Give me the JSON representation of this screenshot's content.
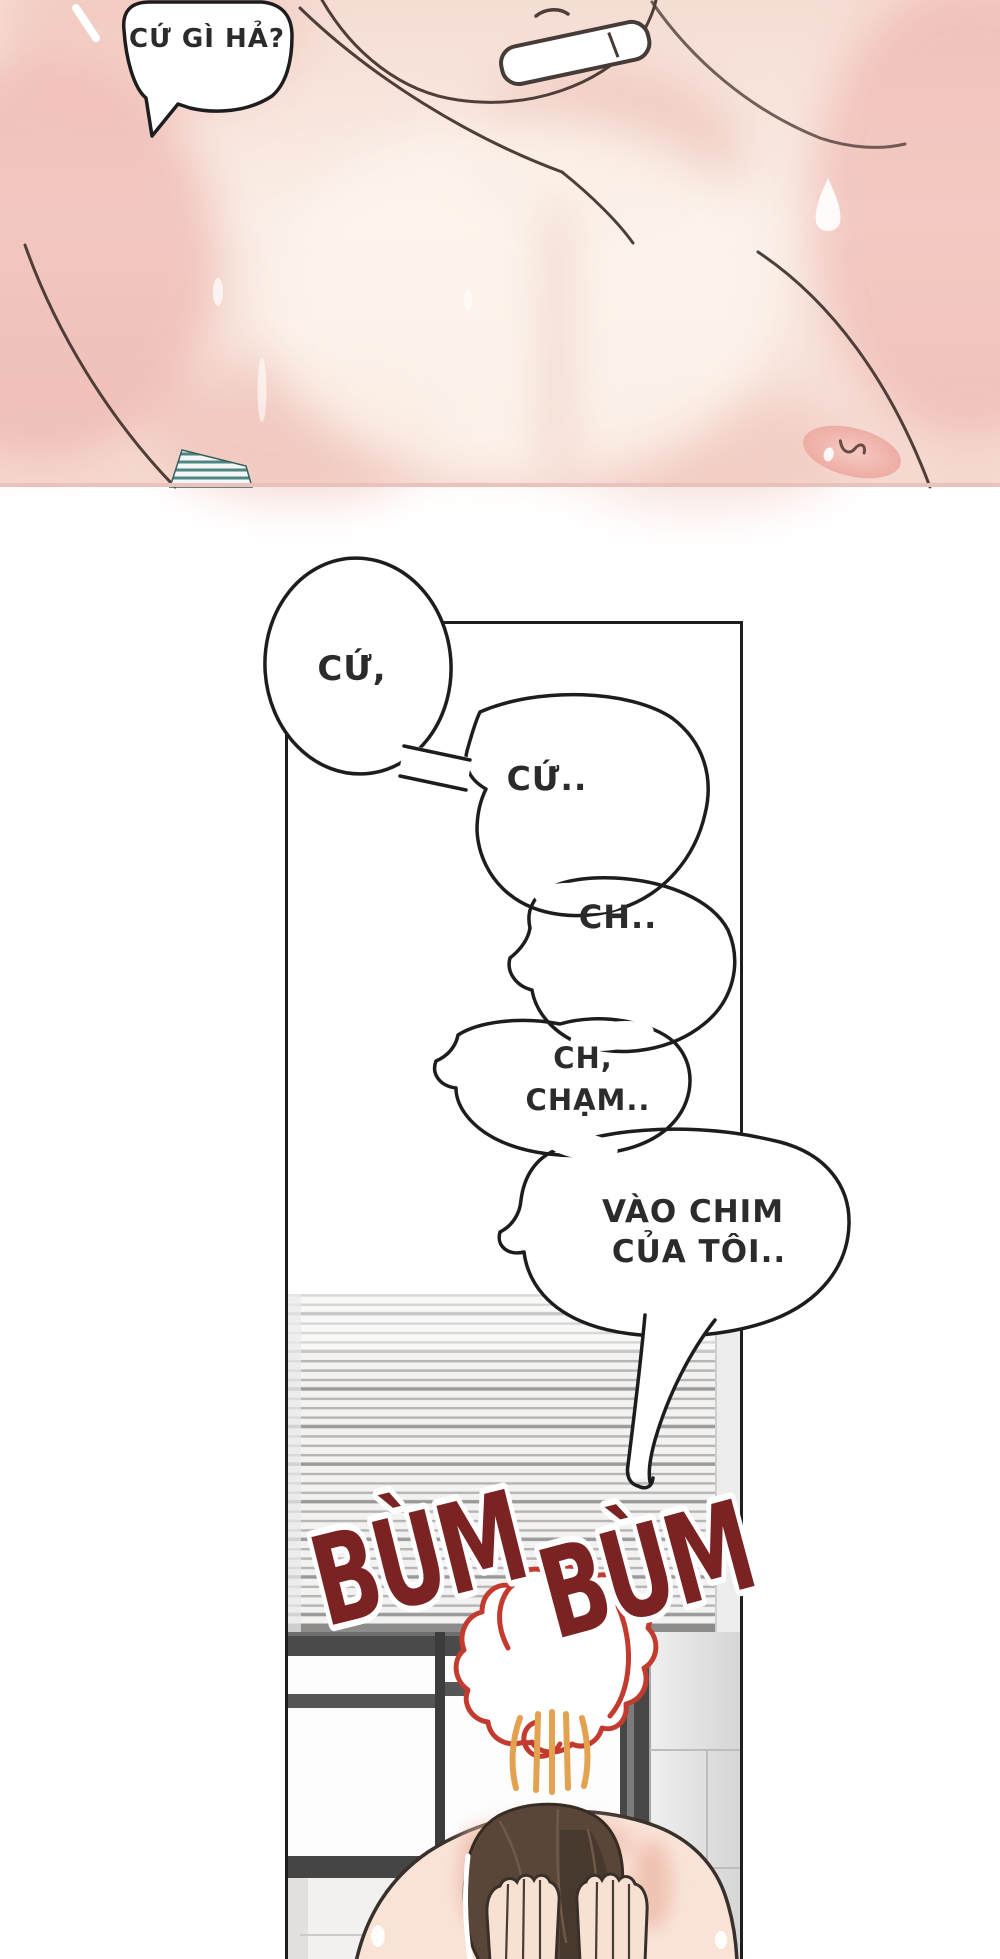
{
  "bubbles": {
    "top": {
      "text": "CỨ GÌ HẢ?"
    },
    "chain": [
      {
        "text": "CỨ,"
      },
      {
        "text": "CỨ.."
      },
      {
        "text": "CH.."
      },
      {
        "lines": [
          "CH,",
          "CHẠM.."
        ]
      },
      {
        "lines": [
          "VÀO CHIM",
          "CỦA TÔI.."
        ]
      }
    ]
  },
  "sfx": {
    "words": [
      "BÙM",
      "BÙM"
    ],
    "color": "#7b2323"
  },
  "colors": {
    "skin_base": "#f8e7de",
    "skin_flush": "#ecaca6",
    "line_art": "#4f3d38",
    "hair_brown": "#584538",
    "steam_cloud_red": "#c23b2e",
    "steam_orange": "#e2a24f",
    "window_frame": "#4a4a4a",
    "wall_tile": "#e6e6e6",
    "blinds_line": "#b5b5b5",
    "bubble_outline": "#1d1d1d"
  }
}
